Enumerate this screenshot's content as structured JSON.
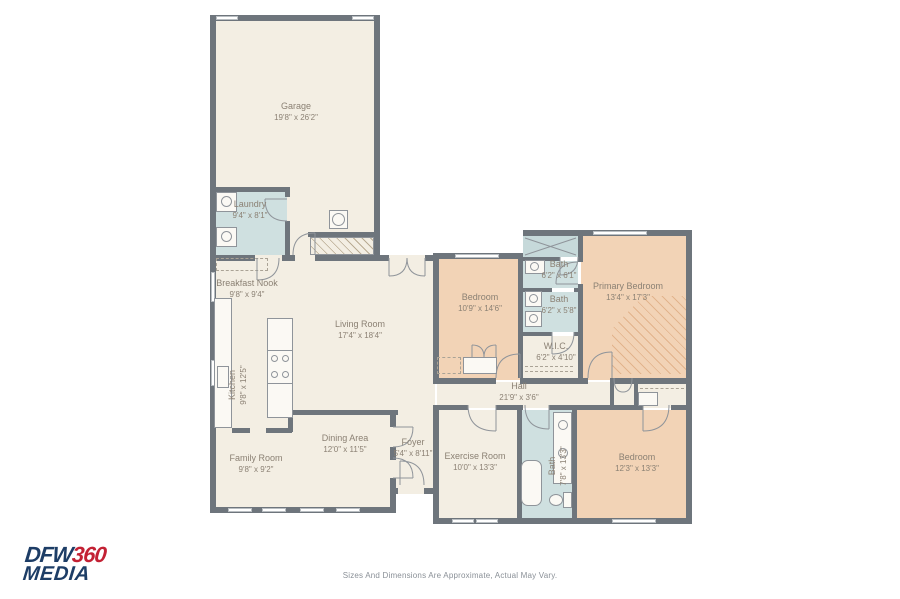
{
  "rooms": [
    {
      "id": "garage",
      "name": "Garage",
      "dims": "19'8\" x 26'2\""
    },
    {
      "id": "laundry",
      "name": "Laundry",
      "dims": "9'4\" x 8'1\""
    },
    {
      "id": "breakfast-nook",
      "name": "Breakfast Nook",
      "dims": "9'8\" x 9'4\""
    },
    {
      "id": "kitchen",
      "name": "Kitchen",
      "dims": "9'8\" x 12'5\""
    },
    {
      "id": "living-room",
      "name": "Living Room",
      "dims": "17'4\" x 18'4\""
    },
    {
      "id": "dining-area",
      "name": "Dining Area",
      "dims": "12'0\" x 11'5\""
    },
    {
      "id": "family-room",
      "name": "Family Room",
      "dims": "9'8\" x 9'2\""
    },
    {
      "id": "foyer",
      "name": "Foyer",
      "dims": "5'4\" x 8'11\""
    },
    {
      "id": "bedroom-2",
      "name": "Bedroom",
      "dims": "10'9\" x 14'6\""
    },
    {
      "id": "bath-1",
      "name": "Bath",
      "dims": "6'2\" x 6'1\""
    },
    {
      "id": "bath-2",
      "name": "Bath",
      "dims": "6'2\" x 5'8\""
    },
    {
      "id": "wic",
      "name": "W.I.C.",
      "dims": "6'2\" x 4'10\""
    },
    {
      "id": "primary-bedroom",
      "name": "Primary Bedroom",
      "dims": "13'4\" x 17'3\""
    },
    {
      "id": "hall",
      "name": "Hall",
      "dims": "21'9\" x 3'6\""
    },
    {
      "id": "exercise-room",
      "name": "Exercise Room",
      "dims": "10'0\" x 13'3\""
    },
    {
      "id": "bath-3",
      "name": "Bath",
      "dims": "7'8\" x 13'3\""
    },
    {
      "id": "bedroom-3",
      "name": "Bedroom",
      "dims": "12'3\" x 13'3\""
    }
  ],
  "logo": {
    "line1": "DFW",
    "line1_accent": "360",
    "line2": "MEDIA"
  },
  "footer": {
    "text": "Sizes And Dimensions Are Approximate, Actual May Vary."
  },
  "colors": {
    "wall": "#6e757c",
    "floor_cream": "#f3eee3",
    "room_peach": "#f2d3b6",
    "room_blue": "#cfe0e0",
    "logo_navy": "#1d3d66",
    "logo_red": "#c32134"
  }
}
